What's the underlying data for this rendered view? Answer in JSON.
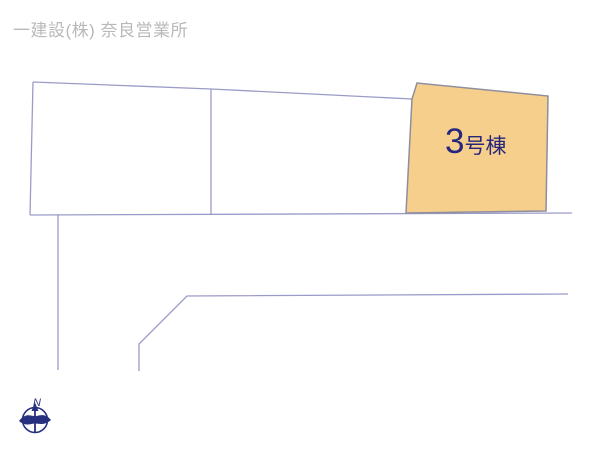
{
  "header": {
    "company_name": "一建設(株) 奈良営業所"
  },
  "map": {
    "highlighted_plot": {
      "label": "3号棟",
      "label_number": "3",
      "label_suffix": "号棟",
      "fill_color": "#f7cf8c",
      "border_color": "#8e8e9e",
      "label_color": "#26267d"
    },
    "line_color": "#9b9bc8",
    "compass": {
      "north_label": "N",
      "color": "#26307e"
    }
  }
}
